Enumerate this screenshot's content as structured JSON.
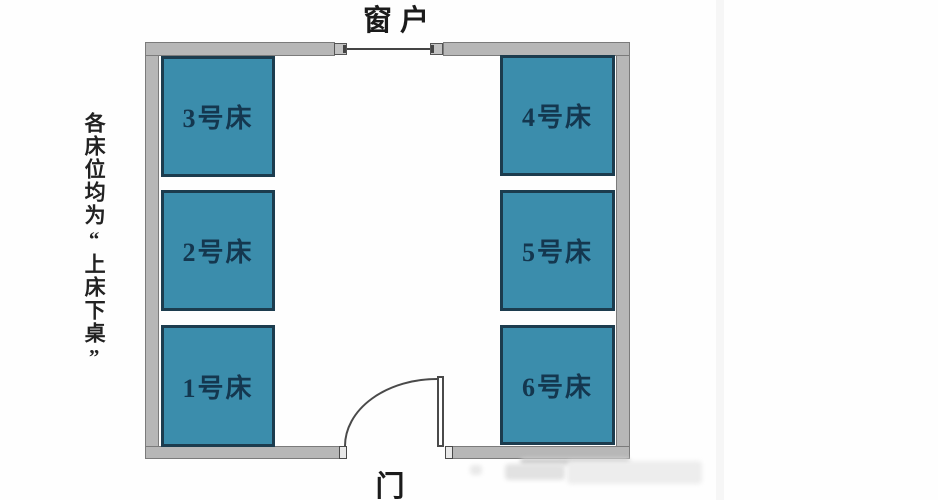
{
  "diagram": {
    "window_label": "窗户",
    "door_label": "门",
    "side_note": "各床位均为“上床下桌”",
    "beds": [
      {
        "label": "1号床"
      },
      {
        "label": "2号床"
      },
      {
        "label": "3号床"
      },
      {
        "label": "4号床"
      },
      {
        "label": "5号床"
      },
      {
        "label": "6号床"
      }
    ],
    "colors": {
      "bed_fill": "#3b8dac",
      "bed_border": "#1c3c4e",
      "bed_text": "#14374f",
      "wall_fill": "#b7b7b7",
      "wall_border": "#7b7b7b",
      "line": "#4a4a4a",
      "label_text": "#1b1b1b"
    }
  }
}
